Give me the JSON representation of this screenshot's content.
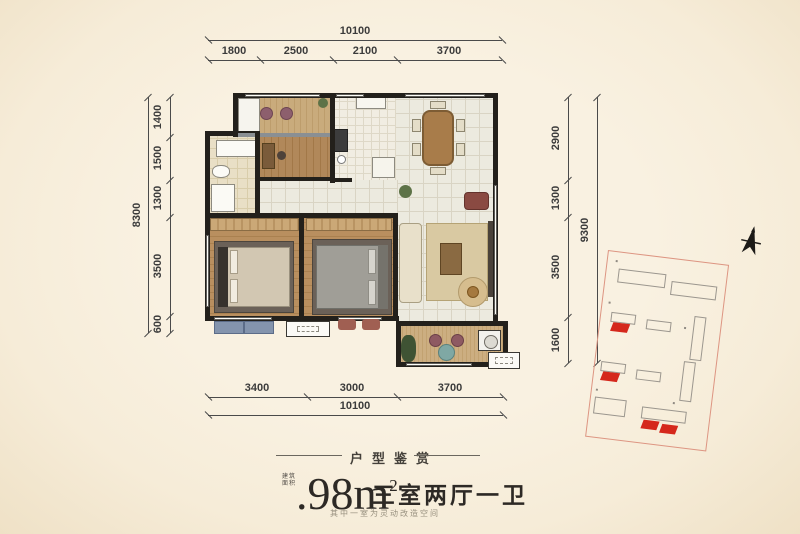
{
  "dims": {
    "top": {
      "total": "10100",
      "segments": [
        "1800",
        "2500",
        "2100",
        "3700"
      ]
    },
    "bottom": {
      "total": "10100",
      "segments": [
        "3400",
        "3000",
        "3700"
      ]
    },
    "left": {
      "total": "8300",
      "segments": [
        "1400",
        "1500",
        "1300",
        "3500",
        "600"
      ]
    },
    "right": {
      "total": "9300",
      "segments": [
        "2900",
        "1300",
        "3500",
        "1600"
      ]
    }
  },
  "caption": {
    "section_title": "户型鉴赏",
    "area_prefix_line1": "建筑",
    "area_prefix_line2": "面积",
    "area_dot": ".",
    "area_value": "98",
    "area_unit": "m",
    "area_sup": "2",
    "rooms_text": "三室两厅一卫",
    "note": "其中一室为灵动改造空间"
  },
  "colors": {
    "background": "#f8efde",
    "wall": "#23201b",
    "dimension_line": "#4a4a4a",
    "highlight_red": "#d5281c",
    "site_plan_border": "#dd9582"
  }
}
